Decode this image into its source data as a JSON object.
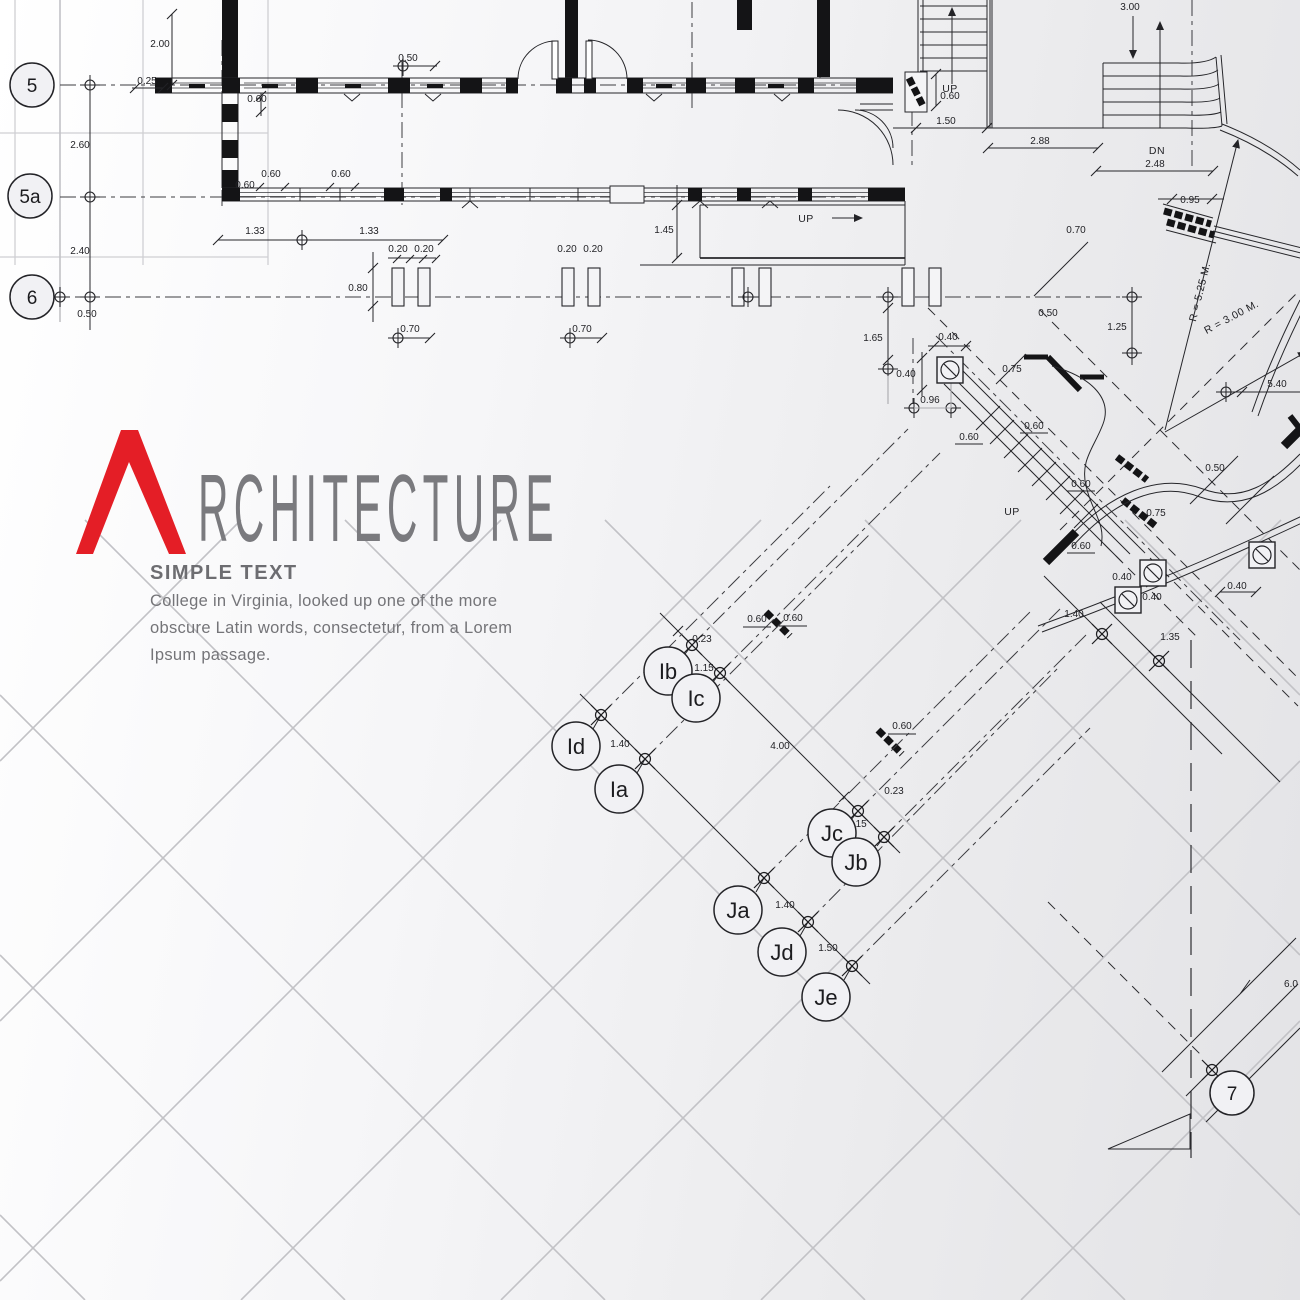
{
  "logo": {
    "initial": "A",
    "word_rest": "RCHITECTURE",
    "subtitle": "SIMPLE TEXT",
    "body_lines": [
      "College in Virginia, looked up one of the more",
      "obscure Latin words, consectetur, from a Lorem",
      "Ipsum passage."
    ],
    "accent_color": "#e41e26",
    "text_color": "#747478"
  },
  "bubbles": {
    "g5": "5",
    "g5a": "5a",
    "g6": "6",
    "g7": "7",
    "ib": "Ib",
    "ic": "Ic",
    "id": "Id",
    "ia": "Ia",
    "jc": "Jc",
    "jb": "Jb",
    "ja": "Ja",
    "jd": "Jd",
    "je": "Je"
  },
  "annotations": {
    "up_ramp": "UP",
    "up_stair": "UP",
    "dn_stair": "DN",
    "up_wing": "UP",
    "radius_outer": "R = 5.25 M.",
    "radius_inner": "R = 3.00 M."
  },
  "dims": [
    "2.00",
    "0.25",
    "0.60",
    "2.60",
    "0.60",
    "0.60",
    "0.60",
    "1.33",
    "2.40",
    "0.50",
    "0.50",
    "1.33",
    "0.20",
    "0.20",
    "0.80",
    "0.20",
    "0.20",
    "0.70",
    "0.70",
    "1.45",
    "1.65",
    "0.40",
    "0.40",
    "0.96",
    "0.75",
    "3.00",
    "0.60",
    "1.50",
    "2.88",
    "2.48",
    "0.95",
    "0.70",
    "0.50",
    "1.25",
    "5.40",
    "0.60",
    "0.60",
    "0.60",
    "0.50",
    "0.75",
    "0.60",
    "0.40",
    "0.40",
    "1.40",
    "0.40",
    "1.35",
    "0.23",
    "0.60",
    "0.60",
    "1.15",
    "1.40",
    "4.00",
    "0.60",
    "0.23",
    "1.15",
    "1.40",
    "1.50",
    "6.0"
  ]
}
